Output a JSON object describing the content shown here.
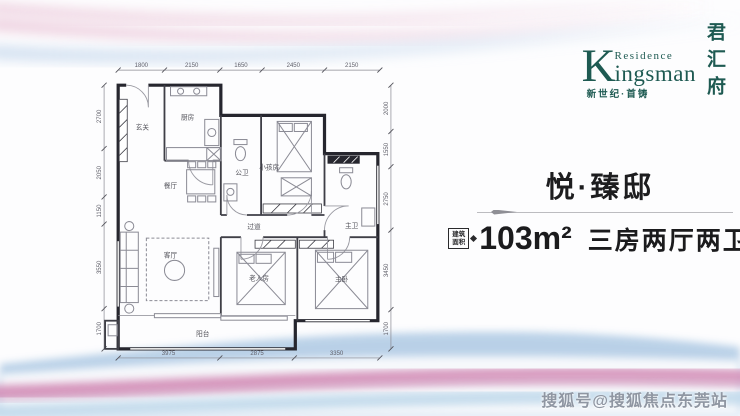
{
  "brand": {
    "k_initial": "K",
    "residence": "Residence",
    "ingsman": "ingsman",
    "vertical_name": "君汇府",
    "tagline": "新世纪·首铸",
    "color": "#1e5a52"
  },
  "panel": {
    "title": "悦·臻邸",
    "area_box_line1": "建筑",
    "area_box_line2": "面积",
    "area_value": "103m²",
    "layout_text": "三房两厅两卫"
  },
  "watermark": "搜狐号@搜狐焦点东莞站",
  "floorplan": {
    "rooms": {
      "entry": "玄关",
      "kitchen": "厨房",
      "dining": "餐厅",
      "public_bath": "公卫",
      "kids_room": "小孩房",
      "corridor": "过道",
      "living": "客厅",
      "elder_room": "老人房",
      "master_bed": "主卧",
      "master_bath": "主卫",
      "balcony": "阳台"
    },
    "dims_top": [
      "1800",
      "2150",
      "1650",
      "2450",
      "2150"
    ],
    "dims_bottom": [
      "3975",
      "2875",
      "3350"
    ],
    "dims_left": [
      "2700",
      "2050",
      "1150",
      "3550",
      "1700"
    ],
    "dims_right": [
      "2000",
      "1550",
      "2750",
      "3450",
      "1700"
    ]
  }
}
